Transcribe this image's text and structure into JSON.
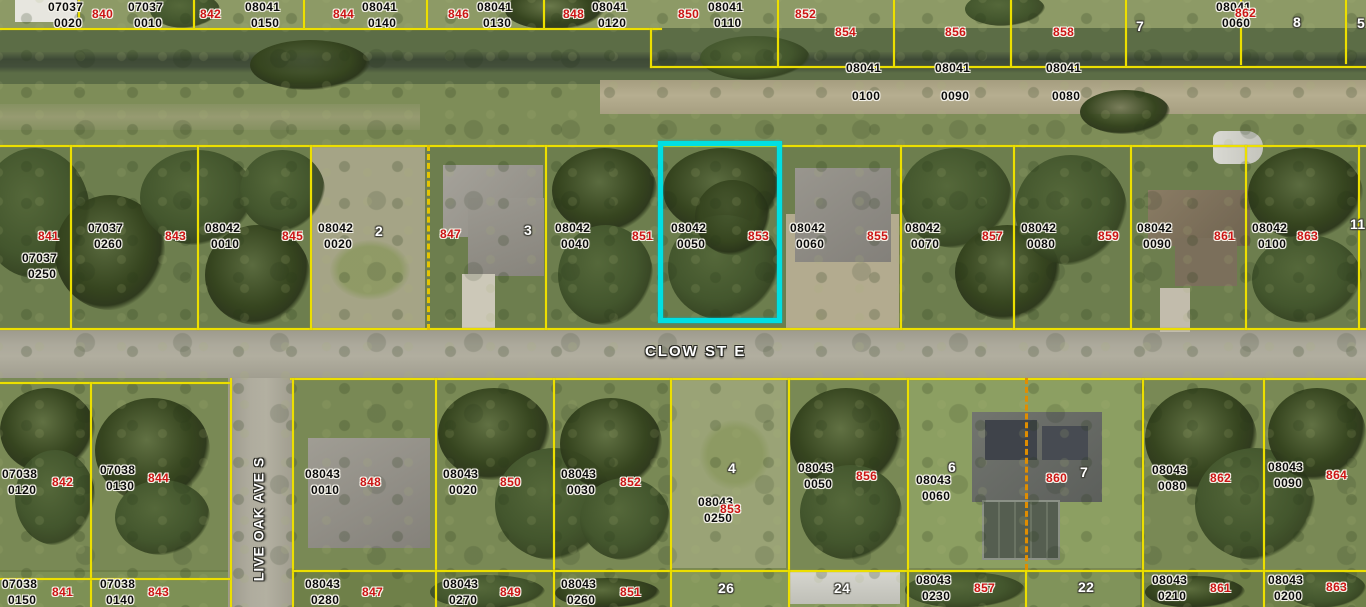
{
  "map": {
    "type": "aerial-parcel-map",
    "streets": {
      "clow": {
        "label": "CLOW ST E",
        "x": 645,
        "y": 343
      },
      "live_oak": {
        "label": "LIVE OAK AVE S",
        "x": 186,
        "y": 511
      }
    },
    "selected_parcel": {
      "strap": "08042 0050",
      "lot": "853",
      "highlight_color": "#00dfe2"
    },
    "colors": {
      "parcel_line": "#ecdf00",
      "highlight": "#00dfe2",
      "lot_number": "#cc1414",
      "parcel_text": "#0b0b0b",
      "block_number": "#ffffff",
      "road": "#aca99b"
    },
    "labels": [
      {
        "t": "p",
        "x": 48,
        "y": 1,
        "l1": "07037",
        "l2": "0020"
      },
      {
        "t": "r",
        "x": 92,
        "y": 8,
        "s": "840"
      },
      {
        "t": "p",
        "x": 128,
        "y": 1,
        "l1": "07037",
        "l2": "0010"
      },
      {
        "t": "r",
        "x": 200,
        "y": 8,
        "s": "842"
      },
      {
        "t": "p",
        "x": 245,
        "y": 1,
        "l1": "08041",
        "l2": "0150"
      },
      {
        "t": "r",
        "x": 333,
        "y": 8,
        "s": "844"
      },
      {
        "t": "p",
        "x": 362,
        "y": 1,
        "l1": "08041",
        "l2": "0140"
      },
      {
        "t": "r",
        "x": 448,
        "y": 8,
        "s": "846"
      },
      {
        "t": "p",
        "x": 477,
        "y": 1,
        "l1": "08041",
        "l2": "0130"
      },
      {
        "t": "r",
        "x": 563,
        "y": 8,
        "s": "848"
      },
      {
        "t": "p",
        "x": 592,
        "y": 1,
        "l1": "08041",
        "l2": "0120"
      },
      {
        "t": "r",
        "x": 678,
        "y": 8,
        "s": "850"
      },
      {
        "t": "p",
        "x": 708,
        "y": 1,
        "l1": "08041",
        "l2": "0110"
      },
      {
        "t": "r",
        "x": 795,
        "y": 8,
        "s": "852"
      },
      {
        "t": "r",
        "x": 835,
        "y": 26,
        "s": "854"
      },
      {
        "t": "p",
        "x": 846,
        "y": 62,
        "l1": "08041",
        "l2": "0100",
        "dy": 28
      },
      {
        "t": "r",
        "x": 945,
        "y": 26,
        "s": "856"
      },
      {
        "t": "p",
        "x": 935,
        "y": 62,
        "l1": "08041",
        "l2": "0090",
        "dy": 28
      },
      {
        "t": "r",
        "x": 1053,
        "y": 26,
        "s": "858"
      },
      {
        "t": "p",
        "x": 1046,
        "y": 62,
        "l1": "08041",
        "l2": "0080",
        "dy": 28
      },
      {
        "t": "w",
        "x": 1136,
        "y": 20,
        "s": "7"
      },
      {
        "t": "p",
        "x": 1216,
        "y": 1,
        "l1": "08041",
        "l2": "0060"
      },
      {
        "t": "r",
        "x": 1235,
        "y": 7,
        "s": "862"
      },
      {
        "t": "w",
        "x": 1293,
        "y": 16,
        "s": "8"
      },
      {
        "t": "w",
        "x": 1357,
        "y": 17,
        "s": "5"
      },
      {
        "t": "r",
        "x": 38,
        "y": 230,
        "s": "841"
      },
      {
        "t": "p",
        "x": 22,
        "y": 252,
        "l1": "07037",
        "l2": "0250"
      },
      {
        "t": "p",
        "x": 88,
        "y": 222,
        "l1": "07037",
        "l2": "0260"
      },
      {
        "t": "r",
        "x": 165,
        "y": 230,
        "s": "843"
      },
      {
        "t": "p",
        "x": 205,
        "y": 222,
        "l1": "08042",
        "l2": "0010"
      },
      {
        "t": "r",
        "x": 282,
        "y": 230,
        "s": "845"
      },
      {
        "t": "p",
        "x": 318,
        "y": 222,
        "l1": "08042",
        "l2": "0020"
      },
      {
        "t": "w",
        "x": 375,
        "y": 225,
        "s": "2"
      },
      {
        "t": "r",
        "x": 440,
        "y": 228,
        "s": "847"
      },
      {
        "t": "w",
        "x": 524,
        "y": 224,
        "s": "3"
      },
      {
        "t": "p",
        "x": 555,
        "y": 222,
        "l1": "08042",
        "l2": "0040"
      },
      {
        "t": "r",
        "x": 632,
        "y": 230,
        "s": "851"
      },
      {
        "t": "p",
        "x": 671,
        "y": 222,
        "l1": "08042",
        "l2": "0050"
      },
      {
        "t": "r",
        "x": 748,
        "y": 230,
        "s": "853"
      },
      {
        "t": "p",
        "x": 790,
        "y": 222,
        "l1": "08042",
        "l2": "0060"
      },
      {
        "t": "r",
        "x": 867,
        "y": 230,
        "s": "855"
      },
      {
        "t": "p",
        "x": 905,
        "y": 222,
        "l1": "08042",
        "l2": "0070"
      },
      {
        "t": "r",
        "x": 982,
        "y": 230,
        "s": "857"
      },
      {
        "t": "p",
        "x": 1021,
        "y": 222,
        "l1": "08042",
        "l2": "0080"
      },
      {
        "t": "r",
        "x": 1098,
        "y": 230,
        "s": "859"
      },
      {
        "t": "p",
        "x": 1137,
        "y": 222,
        "l1": "08042",
        "l2": "0090"
      },
      {
        "t": "r",
        "x": 1214,
        "y": 230,
        "s": "861"
      },
      {
        "t": "p",
        "x": 1252,
        "y": 222,
        "l1": "08042",
        "l2": "0100"
      },
      {
        "t": "r",
        "x": 1297,
        "y": 230,
        "s": "863"
      },
      {
        "t": "w",
        "x": 1350,
        "y": 218,
        "s": "11"
      },
      {
        "t": "p",
        "x": 2,
        "y": 468,
        "l1": "07038",
        "l2": "0120"
      },
      {
        "t": "r",
        "x": 52,
        "y": 476,
        "s": "842"
      },
      {
        "t": "p",
        "x": 100,
        "y": 464,
        "l1": "07038",
        "l2": "0130"
      },
      {
        "t": "r",
        "x": 148,
        "y": 472,
        "s": "844"
      },
      {
        "t": "p",
        "x": 305,
        "y": 468,
        "l1": "08043",
        "l2": "0010"
      },
      {
        "t": "r",
        "x": 360,
        "y": 476,
        "s": "848"
      },
      {
        "t": "p",
        "x": 443,
        "y": 468,
        "l1": "08043",
        "l2": "0020"
      },
      {
        "t": "r",
        "x": 500,
        "y": 476,
        "s": "850"
      },
      {
        "t": "p",
        "x": 561,
        "y": 468,
        "l1": "08043",
        "l2": "0030"
      },
      {
        "t": "r",
        "x": 620,
        "y": 476,
        "s": "852"
      },
      {
        "t": "w",
        "x": 728,
        "y": 462,
        "s": "4"
      },
      {
        "t": "p",
        "x": 698,
        "y": 496,
        "l1": "08043",
        "l2": "0250"
      },
      {
        "t": "r",
        "x": 720,
        "y": 503,
        "s": "853"
      },
      {
        "t": "p",
        "x": 798,
        "y": 462,
        "l1": "08043",
        "l2": "0050"
      },
      {
        "t": "r",
        "x": 856,
        "y": 470,
        "s": "856"
      },
      {
        "t": "p",
        "x": 916,
        "y": 474,
        "l1": "08043",
        "l2": "0060"
      },
      {
        "t": "w",
        "x": 948,
        "y": 461,
        "s": "6"
      },
      {
        "t": "r",
        "x": 1046,
        "y": 472,
        "s": "860"
      },
      {
        "t": "w",
        "x": 1080,
        "y": 466,
        "s": "7"
      },
      {
        "t": "p",
        "x": 1152,
        "y": 464,
        "l1": "08043",
        "l2": "0080"
      },
      {
        "t": "r",
        "x": 1210,
        "y": 472,
        "s": "862"
      },
      {
        "t": "p",
        "x": 1268,
        "y": 461,
        "l1": "08043",
        "l2": "0090"
      },
      {
        "t": "r",
        "x": 1326,
        "y": 469,
        "s": "864"
      },
      {
        "t": "p",
        "x": 2,
        "y": 578,
        "l1": "07038",
        "l2": "0150"
      },
      {
        "t": "r",
        "x": 52,
        "y": 586,
        "s": "841"
      },
      {
        "t": "p",
        "x": 100,
        "y": 578,
        "l1": "07038",
        "l2": "0140"
      },
      {
        "t": "r",
        "x": 148,
        "y": 586,
        "s": "843"
      },
      {
        "t": "p",
        "x": 305,
        "y": 578,
        "l1": "08043",
        "l2": "0280"
      },
      {
        "t": "r",
        "x": 362,
        "y": 586,
        "s": "847"
      },
      {
        "t": "p",
        "x": 443,
        "y": 578,
        "l1": "08043",
        "l2": "0270"
      },
      {
        "t": "r",
        "x": 500,
        "y": 586,
        "s": "849"
      },
      {
        "t": "p",
        "x": 561,
        "y": 578,
        "l1": "08043",
        "l2": "0260"
      },
      {
        "t": "r",
        "x": 620,
        "y": 586,
        "s": "851"
      },
      {
        "t": "w",
        "x": 718,
        "y": 582,
        "s": "26"
      },
      {
        "t": "w",
        "x": 834,
        "y": 582,
        "s": "24"
      },
      {
        "t": "p",
        "x": 916,
        "y": 574,
        "l1": "08043",
        "l2": "0230"
      },
      {
        "t": "r",
        "x": 974,
        "y": 582,
        "s": "857"
      },
      {
        "t": "w",
        "x": 1078,
        "y": 581,
        "s": "22"
      },
      {
        "t": "p",
        "x": 1152,
        "y": 574,
        "l1": "08043",
        "l2": "0210"
      },
      {
        "t": "r",
        "x": 1210,
        "y": 582,
        "s": "861"
      },
      {
        "t": "p",
        "x": 1268,
        "y": 574,
        "l1": "08043",
        "l2": "0200"
      },
      {
        "t": "r",
        "x": 1326,
        "y": 581,
        "s": "863"
      }
    ]
  }
}
